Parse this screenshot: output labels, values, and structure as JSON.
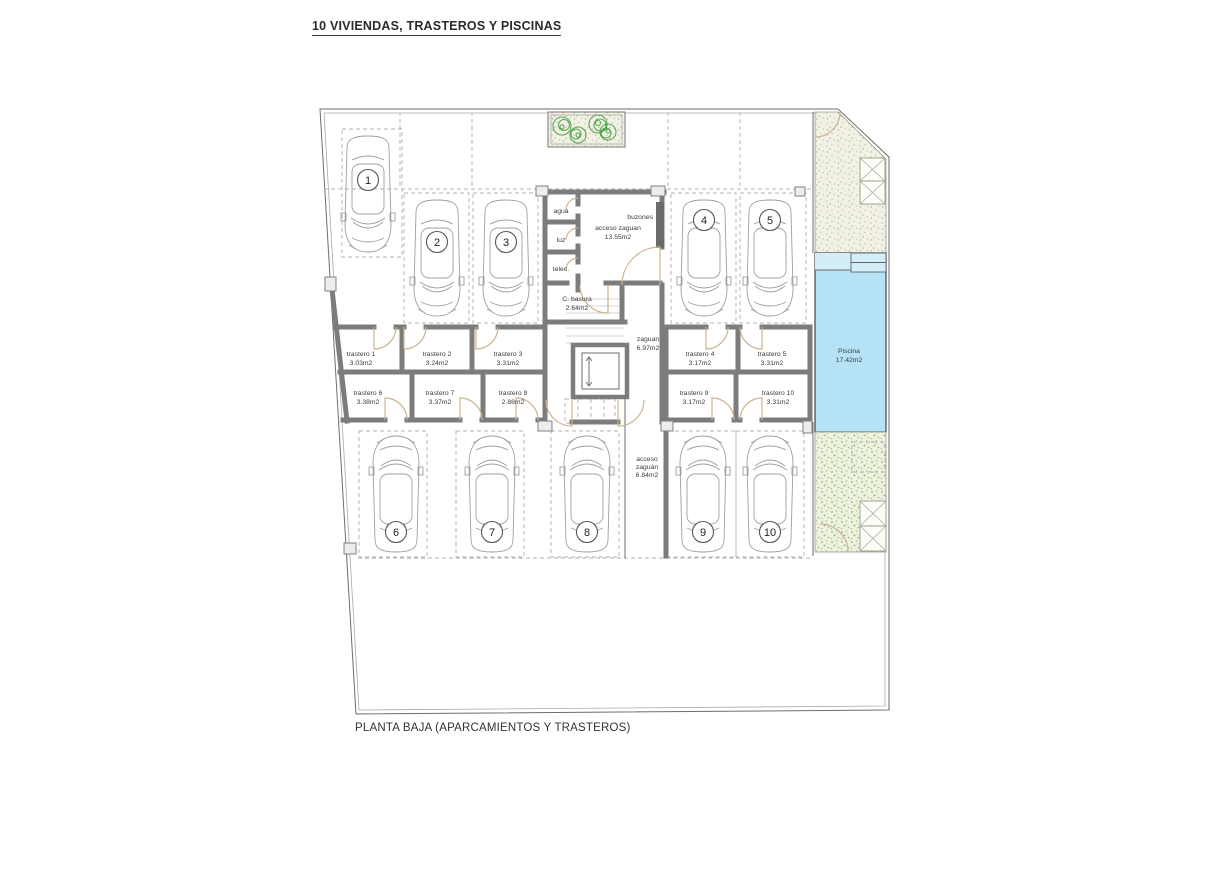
{
  "title": "10 VIVIENDAS, TRASTEROS Y PISCINAS",
  "caption": "PLANTA BAJA (APARCAMIENTOS Y TRASTEROS)",
  "plan": {
    "parking": {
      "spaces": [
        "1",
        "2",
        "3",
        "4",
        "5",
        "6",
        "7",
        "8",
        "9",
        "10"
      ]
    },
    "trasteros": [
      {
        "name": "trastero 1",
        "area": "3.03m2"
      },
      {
        "name": "trastero 2",
        "area": "3.24m2"
      },
      {
        "name": "trastero 3",
        "area": "3.31m2"
      },
      {
        "name": "trastero 4",
        "area": "3.17m2"
      },
      {
        "name": "trastero 5",
        "area": "3.31m2"
      },
      {
        "name": "trastero 6",
        "area": "3.38m2"
      },
      {
        "name": "trastero 7",
        "area": "3.37m2"
      },
      {
        "name": "trastero 8",
        "area": "2.88m2"
      },
      {
        "name": "trastero 9",
        "area": "3.17m2"
      },
      {
        "name": "trastero 10",
        "area": "3.31m2"
      }
    ],
    "rooms": {
      "acceso_zaguan": {
        "name": "acceso zaguan",
        "area": "13.55m2"
      },
      "zaguan": {
        "name": "zaguan",
        "area": "6.97m2"
      },
      "c_basura": {
        "name": "C. basura",
        "area": "2.64m2"
      },
      "acceso_zaguan_2": {
        "line1": "acceso",
        "line2": "zaguán",
        "line3": "6.84m2"
      },
      "piscina": {
        "name": "Piscina",
        "area": "17.42m2"
      }
    },
    "utilities": {
      "agua": "agua",
      "luz": "luz",
      "telec": "telec."
    },
    "buzones": "buzones"
  },
  "colors": {
    "pool": "#b5e2f4",
    "pool_light": "#d3eef9",
    "wall": "#7c7c7c",
    "door_tan": "#cdb492",
    "tree_green": "#3f9b3f"
  }
}
